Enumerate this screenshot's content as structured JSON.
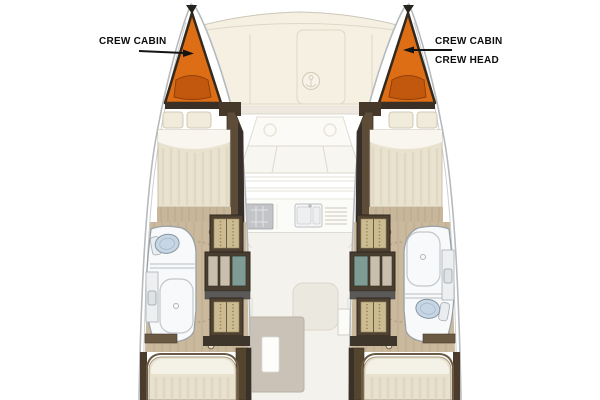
{
  "diagram": {
    "type": "boat-floor-plan",
    "subject": "catamaran deck / accommodation plan, top view, bows up"
  },
  "labels": {
    "port_crew_cabin": "CREW CABIN",
    "starboard_crew_cabin": "CREW CABIN",
    "starboard_crew_head": "CREW HEAD"
  },
  "areas": [
    "port-crew-cabin-bow",
    "starboard-crew-cabin-bow",
    "starboard-crew-head",
    "foredeck",
    "anchor-locker",
    "coachroof",
    "windshield",
    "galley",
    "salon",
    "cockpit-table",
    "port-head",
    "starboard-head",
    "forward-berths",
    "aft-berths",
    "wardrobes",
    "companionway-steps"
  ],
  "colors": {
    "crew_cabin_orange": "#DE6E16",
    "crew_berth_orange": "#C2580E",
    "triangle_outline": "#33291C",
    "hull_outline": "#B6BABD",
    "deck_cream": "#F5F0E2",
    "wood_floor": "#CBB99D",
    "wall_brown": "#5C4C38",
    "wall_dark": "#37302A",
    "bed_cream": "#E9E2CF",
    "pillow": "#F1EBDC",
    "bath_white": "#F8F9FA",
    "toilet_blue": "#C7D6E4",
    "wardrobe_tan": "#CDBC92",
    "steps_teal": "#7E9C93",
    "table_taupe": "#BFB5A7",
    "label_color": "#0D0D0D"
  }
}
